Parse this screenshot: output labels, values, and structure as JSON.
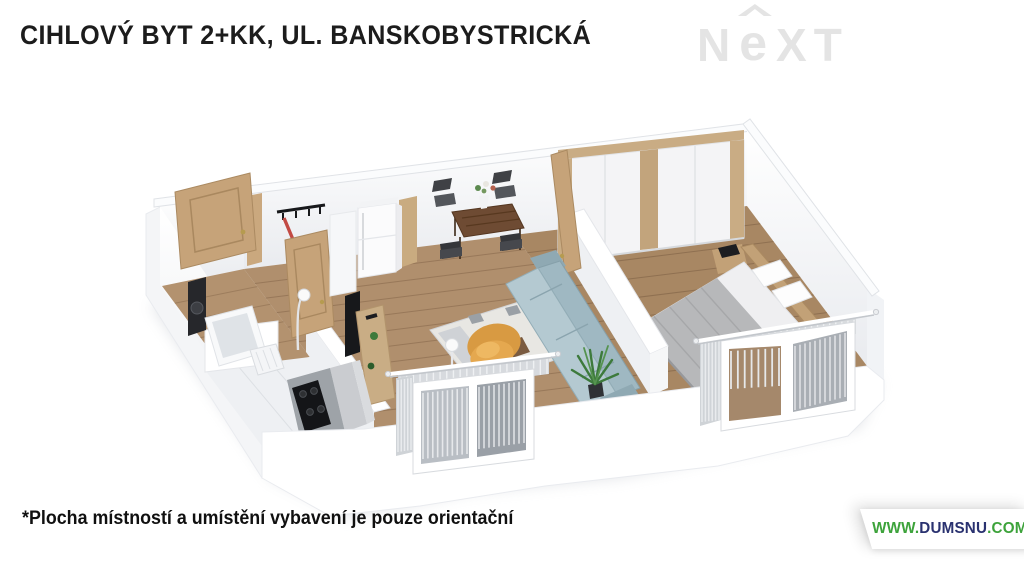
{
  "header": {
    "title": "CIHLOVÝ BYT 2+KK, UL. BANSKOBYSTRICKÁ"
  },
  "logo": {
    "n": "N",
    "e": "e",
    "xt": "XT",
    "color": "#e4e4e4"
  },
  "footnote": {
    "text": "*Plocha místností a umístění vybavení je pouze orientační"
  },
  "watermark": {
    "www": "WWW.",
    "domain": "DUMSNU",
    "tld": ".COM",
    "green": "#3da33b",
    "navy": "#2a3270"
  },
  "floorplan": {
    "description": "3D isometric render of a 2+KK brick apartment floor plan",
    "rooms": [
      "hallway",
      "bathroom",
      "kitchen-corner",
      "living-room-with-dining",
      "bedroom"
    ],
    "furniture": [
      "entrance-door",
      "coat-hooks",
      "bathroom-door",
      "bathtub",
      "washer-column",
      "laundry-basket",
      "kitchen-cooktop",
      "fridge",
      "tv-panel",
      "wood-sideboard",
      "arc-lamp",
      "dining-table",
      "dining-chairs",
      "vase-with-flowers",
      "rug",
      "orange-armchair",
      "blue-sofa",
      "floor-lamp",
      "potted-plant",
      "bedroom-door",
      "wardrobe",
      "night-shelf",
      "double-bed",
      "pillows",
      "living-window-with-curtains",
      "bedroom-windows-with-curtains",
      "curtain-rods"
    ],
    "palette": {
      "wall": "#ffffff",
      "wall_shade": "#f2f3f6",
      "floor_wood": "#b08f6d",
      "floor_wood_dark": "#a88763",
      "door_wood": "#c6a379",
      "wardrobe_trim": "#c9ac84",
      "sofa_blue": "#aec5ce",
      "armchair_orange": "#e5a84f",
      "blanket_gray": "#b7b8ba",
      "counter_dark": "#2e3033",
      "plant_green": "#3d7a3c",
      "curtain_gray": "#d8dbde"
    }
  }
}
